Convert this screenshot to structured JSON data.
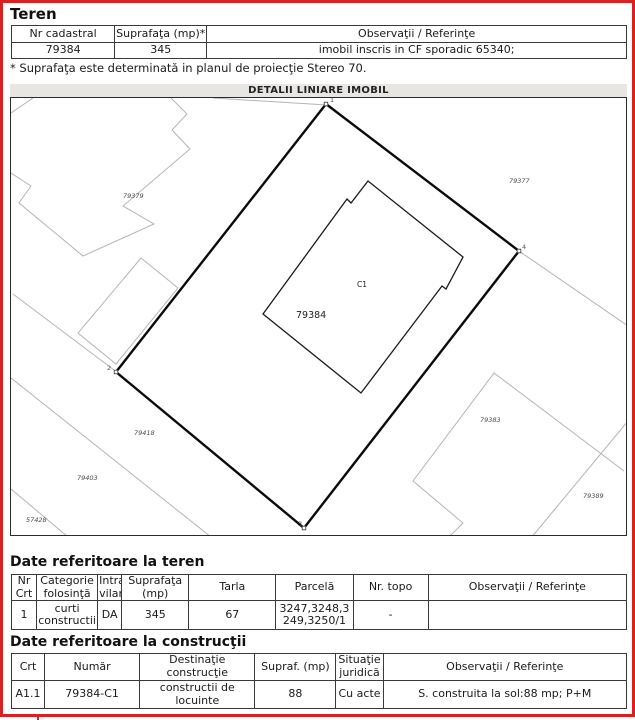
{
  "colors": {
    "page_border": "#d92121",
    "map_title_bg": "#e8e6e3",
    "table_border": "#3a3a3a",
    "neighbor_line": "#b4b4b4",
    "parcel_line": "#0b0b0b"
  },
  "teren": {
    "heading": "Teren",
    "table": {
      "headers": [
        "Nr cadastral",
        "Suprafaţa (mp)*",
        "Observaţii / Referinţe"
      ],
      "row": [
        "79384",
        "345",
        "imobil inscris in CF sporadic 65340;"
      ]
    },
    "note": "* Suprafaţa este determinată in planul de proiecţie Stereo 70."
  },
  "map": {
    "title": "DETALII LINIARE IMOBIL",
    "labels": {
      "p79379": "79379",
      "p79377": "79377",
      "p79418": "79418",
      "p79403": "79403",
      "p57428": "57428",
      "p79383": "79383",
      "p79389": "79389",
      "parcel": "79384",
      "building": "C1"
    },
    "vertices": {
      "v1": "1",
      "v2": "2",
      "v3": "3",
      "v4": "4"
    }
  },
  "teren_detail": {
    "heading": "Date referitoare la teren",
    "headers": [
      {
        "lines": [
          "Nr",
          "Crt"
        ]
      },
      {
        "lines": [
          "Categorie",
          "folosinţă"
        ]
      },
      {
        "lines": [
          "Intra",
          "vilan"
        ]
      },
      {
        "lines": [
          "Suprafaţa",
          "(mp)"
        ]
      },
      {
        "lines": [
          "Tarla"
        ]
      },
      {
        "lines": [
          "Parcelă"
        ]
      },
      {
        "lines": [
          "Nr. topo"
        ]
      },
      {
        "lines": [
          "Observaţii / Referinţe"
        ]
      }
    ],
    "row": [
      "1",
      "curti constructii",
      "DA",
      "345",
      "67",
      "3247,3248,3249,3250/1",
      "-",
      ""
    ]
  },
  "constructii": {
    "heading": "Date referitoare la construcţii",
    "headers": [
      {
        "lines": [
          "Crt"
        ]
      },
      {
        "lines": [
          "Număr"
        ]
      },
      {
        "lines": [
          "Destinaţie",
          "construcţie"
        ]
      },
      {
        "lines": [
          "Supraf. (mp)"
        ]
      },
      {
        "lines": [
          "Situaţie",
          "juridică"
        ]
      },
      {
        "lines": [
          "Observaţii / Referinţe"
        ]
      }
    ],
    "row": [
      "A1.1",
      "79384-C1",
      "constructii de locuinte",
      "88",
      "Cu acte",
      "S. construita la sol:88 mp;  P+M"
    ]
  }
}
